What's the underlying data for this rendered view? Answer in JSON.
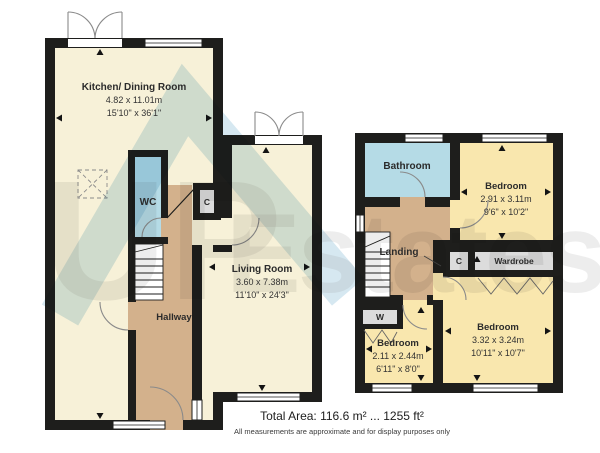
{
  "watermark": {
    "line1": "UP",
    "line2": "Estates"
  },
  "colors": {
    "wall": "#1e1e1c",
    "cream": "#f7f1d8",
    "yellow": "#f9e7ae",
    "blue": "#b5dbe6",
    "tan": "#d3b18c",
    "gray": "#dcdcdc",
    "stairs": "#ffffff",
    "watermark_text": "#8f8f8f",
    "watermark_roof": "#9ec9de"
  },
  "ground_floor": {
    "kitchen": {
      "name": "Kitchen/ Dining Room",
      "metric": "4.82 x 11.01m",
      "imperial": "15'10\" x 36'1\""
    },
    "living": {
      "name": "Living Room",
      "metric": "3.60 x 7.38m",
      "imperial": "11'10\" x 24'3\""
    },
    "hallway": {
      "name": "Hallway"
    },
    "wc": {
      "name": "WC"
    },
    "cupboard": {
      "name": "C"
    }
  },
  "first_floor": {
    "bathroom": {
      "name": "Bathroom"
    },
    "bedroom_top": {
      "name": "Bedroom",
      "metric": "2.91 x 3.11m",
      "imperial": "9'6\" x 10'2\""
    },
    "landing": {
      "name": "Landing"
    },
    "cupboard": {
      "name": "C"
    },
    "wardrobe": {
      "name": "Wardrobe"
    },
    "wardrobe_small": {
      "name": "W"
    },
    "bedroom_small": {
      "name": "Bedroom",
      "metric": "2.11 x 2.44m",
      "imperial": "6'11\" x 8'0\""
    },
    "bedroom_large": {
      "name": "Bedroom",
      "metric": "3.32 x 3.24m",
      "imperial": "10'11\" x 10'7\""
    }
  },
  "footer": {
    "total_area": "Total Area: 116.6 m² ... 1255 ft²",
    "disclaimer": "All measurements are approximate and for display purposes only"
  }
}
